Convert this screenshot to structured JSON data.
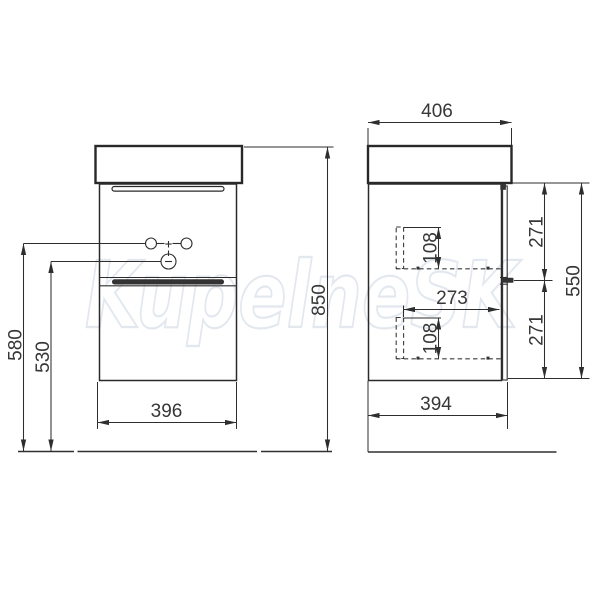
{
  "watermark": {
    "text": "KupelneSK",
    "color": "#e3e8ef"
  },
  "drawing": {
    "ink_color": "#2e2e2e",
    "front_view": {
      "title": "front view",
      "dimensions": {
        "total_height_mm": "850",
        "tap_holes_height_mm": "580",
        "mixer_hole_height_mm": "530",
        "cabinet_width_mm": "396"
      }
    },
    "side_view": {
      "title": "side view",
      "dimensions": {
        "worktop_depth_mm": "406",
        "upper_drawer_front_mm": "271",
        "lower_drawer_front_mm": "271",
        "front_total_mm": "550",
        "drawer_box_depth_mm": "273",
        "upper_drawer_box_height_mm": "108",
        "lower_drawer_box_height_mm": "108",
        "cabinet_depth_mm": "394"
      }
    }
  }
}
